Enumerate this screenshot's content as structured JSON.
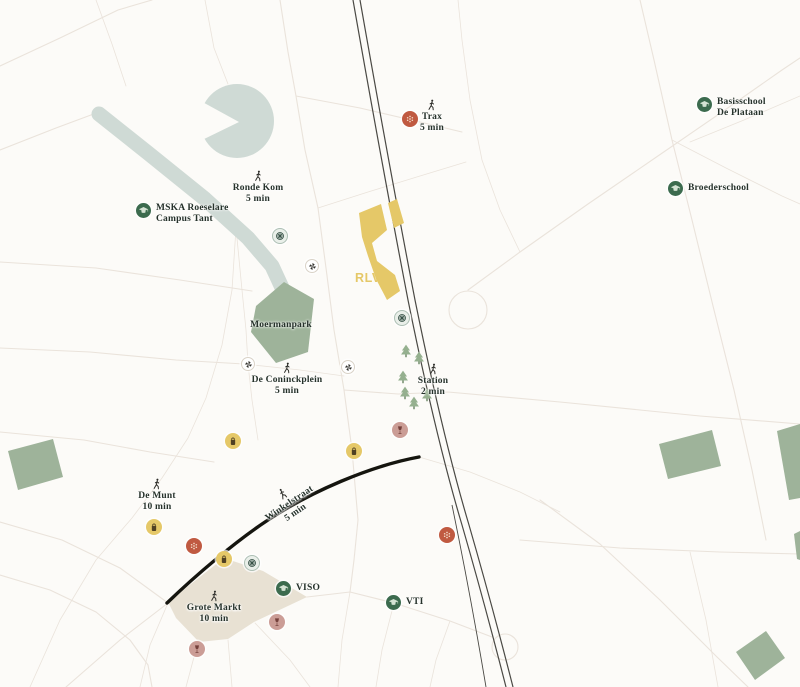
{
  "site": {
    "label": "RLVD"
  },
  "markers": {
    "trax": {
      "line1": "Trax",
      "line2": "5 min"
    },
    "ronde_kom": {
      "line1": "Ronde Kom",
      "line2": "5 min"
    },
    "mska": {
      "line1": "MSKA Roeselare",
      "line2": "Campus Tant"
    },
    "basisschool": {
      "line1": "Basisschool",
      "line2": "De Plataan"
    },
    "broederschool": {
      "line1": "Broederschool"
    },
    "moermanpark": {
      "line1": "Moermanpark"
    },
    "coninckplein": {
      "line1": "De Coninckplein",
      "line2": "5 min"
    },
    "station": {
      "line1": "Station",
      "line2": "2 min"
    },
    "de_munt": {
      "line1": "De Munt",
      "line2": "10 min"
    },
    "winkelstraat": {
      "line1": "Winkelstraat",
      "line2": "5 min"
    },
    "viso": {
      "line1": "VISO"
    },
    "vti": {
      "line1": "VTI"
    },
    "grote_markt": {
      "line1": "Grote Markt",
      "line2": "10 min"
    }
  },
  "icons": {
    "walking_person": "walk-figure",
    "school": "graduation-cap",
    "shopping": "shopping-bag",
    "food": "dot-flower",
    "drinks": "wine-glass",
    "mobility": "spoked-wheel",
    "activity": "pinwheel",
    "vegetation": "pine-tree"
  },
  "colors": {
    "background": "#fcfbf8",
    "road": "#eae3db",
    "water": "#cfdad5",
    "park": "#9eb39a",
    "market_square": "#e8e1d3",
    "accent_yellow": "#e5c868",
    "railway": "#4a4944",
    "street_black": "#15150f",
    "label_text": "#26322b",
    "school_green": "#3c6b4e",
    "poi_red": "#c05a41",
    "poi_pink": "#cb9d96",
    "poi_yellow": "#e5c868",
    "wheel_bg": "#e9efe9",
    "tree": "#95b08f",
    "tree_trunk": "#7f9779"
  }
}
